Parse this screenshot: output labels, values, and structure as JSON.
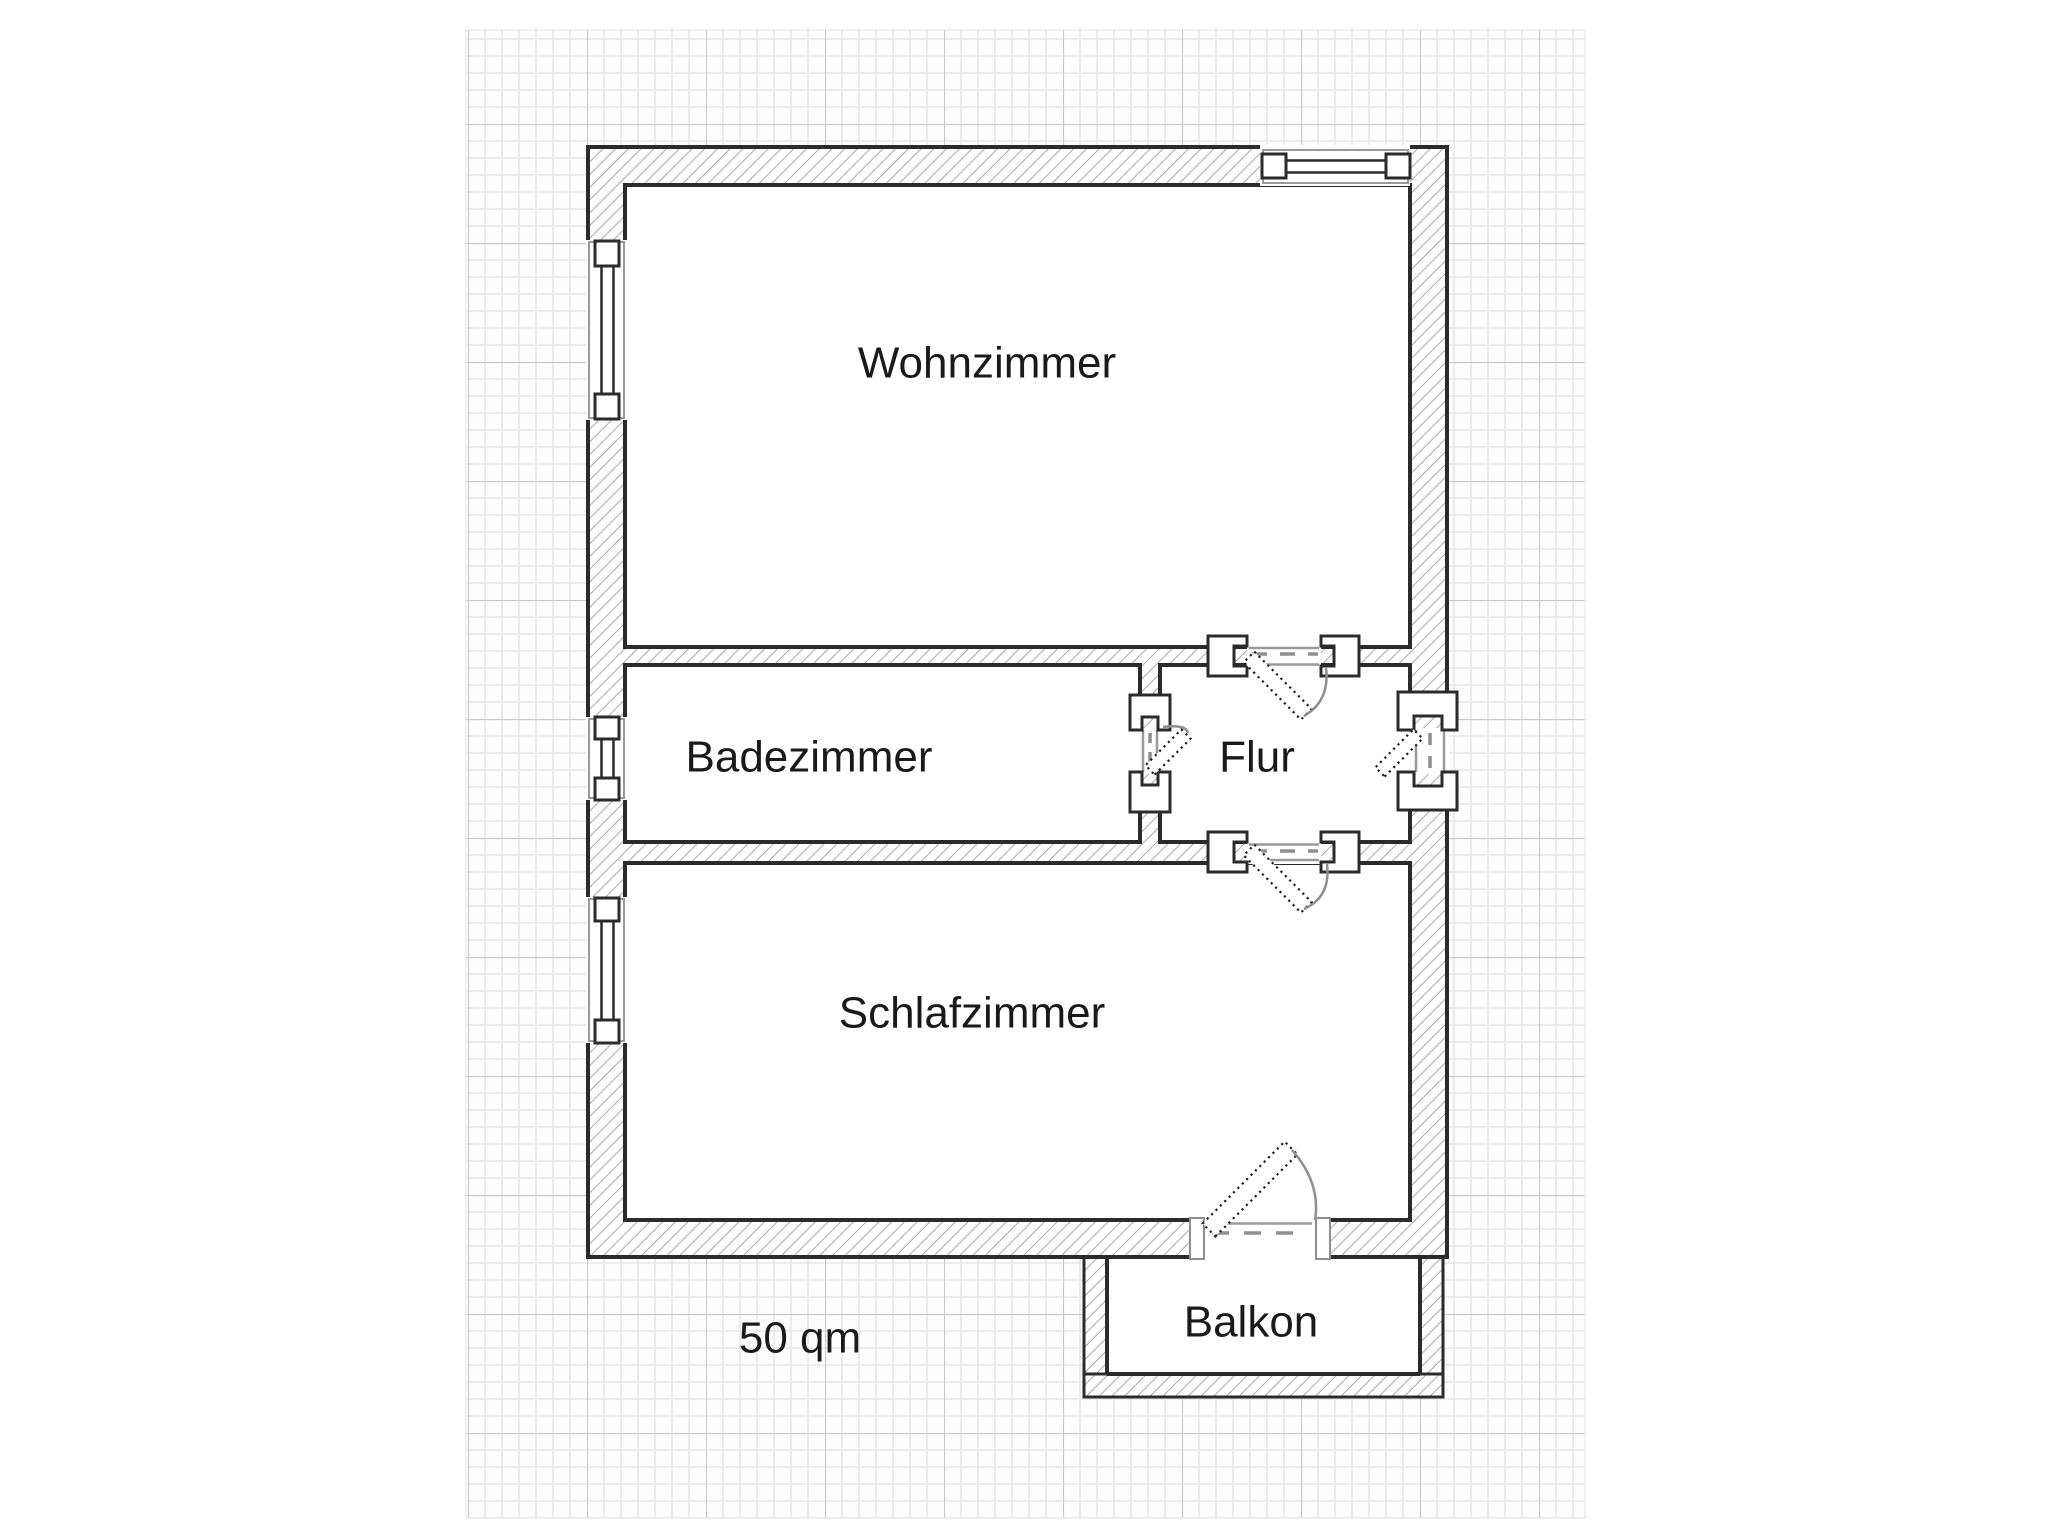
{
  "page": {
    "background_color": "#ffffff",
    "type": "floor-plan-drawing"
  },
  "floorplan": {
    "rooms": {
      "wohnzimmer": {
        "label": "Wohnzimmer"
      },
      "badezimmer": {
        "label": "Badezimmer"
      },
      "flur": {
        "label": "Flur"
      },
      "schlafzimmer": {
        "label": "Schlafzimmer"
      },
      "balkon": {
        "label": "Balkon"
      }
    },
    "annotations": {
      "total_area": "50 qm"
    },
    "symbols": {
      "windows": [
        "window-left-wohnzimmer",
        "window-left-badezimmer",
        "window-left-schlafzimmer",
        "window-top-wohnzimmer"
      ],
      "doors": [
        "door-wohnzimmer-flur",
        "door-badezimmer-flur",
        "door-entrance-flur",
        "door-flur-schlafzimmer",
        "door-schlafzimmer-balkon"
      ]
    },
    "colors": {
      "wall_outline": "#2b2b2b",
      "wall_hatch": "#a4a4a4",
      "grid_minor": "#e7e7e7",
      "grid_major": "#c9c9c9",
      "door_swing_gray": "#8f8f8f",
      "window_frame_gray": "#9a9a9a",
      "label_text": "#1a1a1a"
    }
  }
}
